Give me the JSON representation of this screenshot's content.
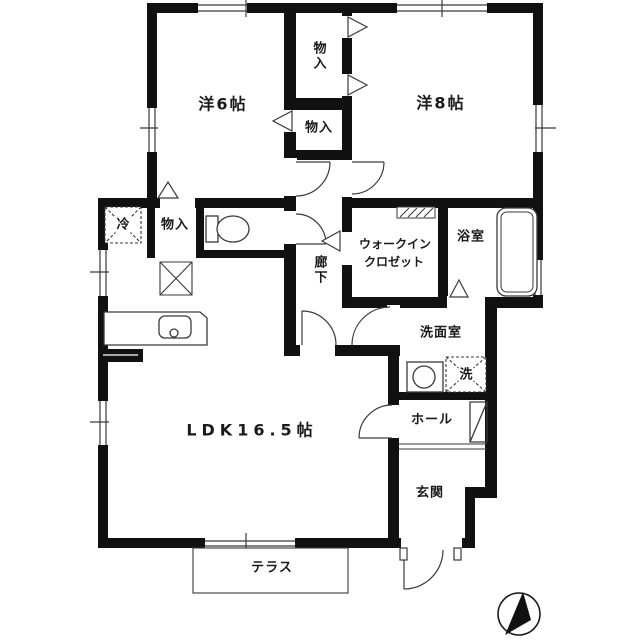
{
  "floorplan": {
    "rooms": {
      "western6": "洋6帖",
      "western8": "洋8帖",
      "ldk": "LDK16.5帖",
      "corridor": "廊下",
      "wic_line1": "ウォークイン",
      "wic_line2": "クロゼット",
      "bathroom": "浴室",
      "washroom": "洗面室",
      "hall": "ホール",
      "entrance": "玄関",
      "terrace": "テラス"
    },
    "storage": {
      "closet_top": "物入",
      "closet_mid": "物入",
      "closet_kitchen": "物入"
    },
    "appliances": {
      "refrigerator": "冷",
      "washer": "洗"
    },
    "colors": {
      "wall": "#111111",
      "line": "#3a3a3a",
      "background": "#ffffff",
      "text": "#1a1a1a"
    }
  }
}
